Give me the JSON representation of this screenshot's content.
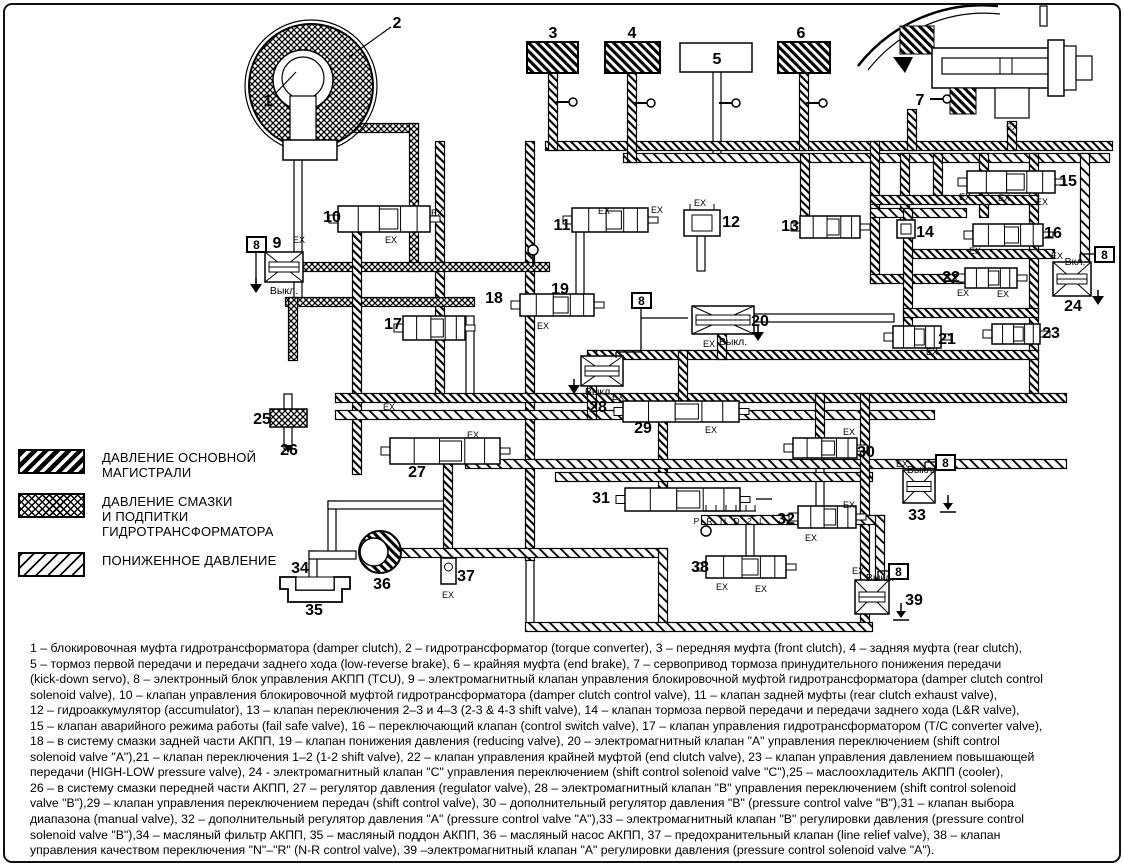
{
  "legend": {
    "items": [
      {
        "id": "main",
        "label": "ДАВЛЕНИЕ ОСНОВНОЙ\nМАГИСТРАЛИ"
      },
      {
        "id": "lube",
        "label": "ДАВЛЕНИЕ СМАЗКИ\nИ ПОДПИТКИ\nГИДРОТРАНСФОРМАТОРА"
      },
      {
        "id": "low",
        "label": "ПОНИЖЕННОЕ ДАВЛЕНИЕ"
      }
    ]
  },
  "diagram": {
    "callouts": [
      {
        "t": "1",
        "x": 268,
        "y": 101
      },
      {
        "t": "2",
        "x": 397,
        "y": 23
      },
      {
        "t": "3",
        "x": 553,
        "y": 33
      },
      {
        "t": "4",
        "x": 632,
        "y": 33
      },
      {
        "t": "5",
        "x": 717,
        "y": 59
      },
      {
        "t": "6",
        "x": 801,
        "y": 33
      },
      {
        "t": "7",
        "x": 920,
        "y": 100
      },
      {
        "t": "9",
        "x": 277,
        "y": 243
      },
      {
        "t": "10",
        "x": 332,
        "y": 217
      },
      {
        "t": "11",
        "x": 562,
        "y": 225
      },
      {
        "t": "12",
        "x": 731,
        "y": 222
      },
      {
        "t": "13",
        "x": 790,
        "y": 226
      },
      {
        "t": "14",
        "x": 925,
        "y": 232
      },
      {
        "t": "15",
        "x": 1068,
        "y": 181
      },
      {
        "t": "16",
        "x": 1053,
        "y": 233
      },
      {
        "t": "17",
        "x": 393,
        "y": 324
      },
      {
        "t": "18",
        "x": 494,
        "y": 298
      },
      {
        "t": "19",
        "x": 560,
        "y": 289
      },
      {
        "t": "20",
        "x": 760,
        "y": 321
      },
      {
        "t": "21",
        "x": 947,
        "y": 339
      },
      {
        "t": "22",
        "x": 951,
        "y": 277
      },
      {
        "t": "23",
        "x": 1051,
        "y": 333
      },
      {
        "t": "24",
        "x": 1073,
        "y": 306
      },
      {
        "t": "25",
        "x": 262,
        "y": 419
      },
      {
        "t": "26",
        "x": 289,
        "y": 450
      },
      {
        "t": "27",
        "x": 417,
        "y": 472
      },
      {
        "t": "28",
        "x": 598,
        "y": 407
      },
      {
        "t": "29",
        "x": 643,
        "y": 428
      },
      {
        "t": "30",
        "x": 866,
        "y": 452
      },
      {
        "t": "31",
        "x": 601,
        "y": 498
      },
      {
        "t": "32",
        "x": 786,
        "y": 519
      },
      {
        "t": "33",
        "x": 917,
        "y": 515
      },
      {
        "t": "34",
        "x": 300,
        "y": 568
      },
      {
        "t": "35",
        "x": 314,
        "y": 610
      },
      {
        "t": "36",
        "x": 382,
        "y": 584
      },
      {
        "t": "37",
        "x": 466,
        "y": 576
      },
      {
        "t": "38",
        "x": 700,
        "y": 567
      },
      {
        "t": "39",
        "x": 914,
        "y": 600
      }
    ],
    "tcu_boxes": [
      {
        "t": "8",
        "x": 247,
        "y": 237
      },
      {
        "t": "8",
        "x": 632,
        "y": 293
      },
      {
        "t": "8",
        "x": 1095,
        "y": 247
      },
      {
        "t": "8",
        "x": 936,
        "y": 455
      },
      {
        "t": "8",
        "x": 889,
        "y": 564
      }
    ],
    "ex_labels": [
      {
        "t": "EX",
        "x": 299,
        "y": 240
      },
      {
        "t": "EX",
        "x": 391,
        "y": 240
      },
      {
        "t": "EX",
        "x": 437,
        "y": 213
      },
      {
        "t": "EX",
        "x": 604,
        "y": 211
      },
      {
        "t": "EX",
        "x": 657,
        "y": 210
      },
      {
        "t": "EX",
        "x": 700,
        "y": 203
      },
      {
        "t": "EX",
        "x": 965,
        "y": 197
      },
      {
        "t": "EX",
        "x": 1004,
        "y": 198
      },
      {
        "t": "EX",
        "x": 1042,
        "y": 202
      },
      {
        "t": "EX",
        "x": 975,
        "y": 251
      },
      {
        "t": "EX",
        "x": 543,
        "y": 326
      },
      {
        "t": "EX",
        "x": 932,
        "y": 352
      },
      {
        "t": "EX",
        "x": 963,
        "y": 293
      },
      {
        "t": "EX",
        "x": 1003,
        "y": 294
      },
      {
        "t": "EX",
        "x": 1057,
        "y": 256
      },
      {
        "t": "EX",
        "x": 389,
        "y": 407
      },
      {
        "t": "EX",
        "x": 473,
        "y": 435
      },
      {
        "t": "EX",
        "x": 618,
        "y": 397
      },
      {
        "t": "EX",
        "x": 711,
        "y": 430
      },
      {
        "t": "EX",
        "x": 849,
        "y": 432
      },
      {
        "t": "EX",
        "x": 849,
        "y": 505
      },
      {
        "t": "EX",
        "x": 811,
        "y": 538
      },
      {
        "t": "EX",
        "x": 902,
        "y": 464
      },
      {
        "t": "EX",
        "x": 448,
        "y": 595
      },
      {
        "t": "EX",
        "x": 722,
        "y": 587
      },
      {
        "t": "EX",
        "x": 761,
        "y": 589
      },
      {
        "t": "EX",
        "x": 858,
        "y": 571
      },
      {
        "t": "EX",
        "x": 1012,
        "y": 127
      },
      {
        "t": "EX",
        "x": 709,
        "y": 344
      }
    ],
    "state_labels": [
      {
        "t": "Выкл.",
        "x": 284,
        "y": 290
      },
      {
        "t": "Выкл.",
        "x": 733,
        "y": 341
      },
      {
        "t": "Выкл.",
        "x": 599,
        "y": 391
      },
      {
        "t": "Выкл.",
        "x": 921,
        "y": 469
      },
      {
        "t": "Выкл.",
        "x": 880,
        "y": 577
      },
      {
        "t": "Вкл.",
        "x": 1075,
        "y": 261
      }
    ],
    "range_indicator": "P R N D 2 L"
  },
  "caption": {
    "lines": [
      "1 – блокировочная муфта гидротрансформатора (damper clutch), 2 – гидротрансформатор (torque converter), 3 – передняя муфта (front clutch), 4 – задняя муфта (rear clutch),",
      "5 – тормоз первой передачи и передачи заднего хода (low-reverse brake), 6 – крайняя муфта (end brake), 7 – сервопривод тормоза принудительного понижения передачи",
      "(kick-down servo), 8 – электронный блок управления АКПП (TCU), 9 – электромагнитный клапан управления блокировочной муфтой гидротрансформатора (damper clutch control",
      "solenoid valve), 10 – клапан управления блокировочной муфтой гидротрансформатора (damper clutch control valve), 11 – клапан задней муфты (rear clutch exhaust valve),",
      "12 – гидроаккумулятор (accumulator), 13 – клапан переключения 2–3 и 4–3 (2-3 & 4-3 shift valve), 14 – клапан тормоза первой передачи и передачи заднего хода (L&R valve),",
      "15 – клапан аварийного режима работы (fail safe valve), 16 – переключающий клапан (control switch valve), 17 – клапан управления гидротрансформатором (T/C converter valve),",
      "18 – в систему смазки задней части АКПП, 19 – клапан понижения давления (reducing valve), 20 – электромагнитный клапан \"А\" управления переключением (shift control",
      "solenoid valve \"A\"),21 – клапан переключения 1–2 (1-2 shift valve), 22 – клапан управления крайней муфтой (end clutch valve), 23 – клапан управления давлением повышающей",
      "передачи (HIGH-LOW pressure valve), 24 - электромагнитный клапан \"С\" управления переключением (shift control solenoid valve \"С\"),25 – маслоохладитель АКПП (cooler),",
      "26 – в систему смазки передней части АКПП, 27 – регулятор давления (regulator valve), 28 – электромагнитный клапан \"В\" управления переключением (shift control solenoid",
      "valve \"В\"),29 – клапан управления переключением передач (shift control valve), 30 – дополнительный регулятор давления \"В\" (pressure control valve \"В\"),31 – клапан выбора",
      "диапазона (manual valve), 32 – дополнительный регулятор давления \"А\" (pressure control valve \"А\"),33 – электромагнитный клапан \"В\" регулировки давления (pressure control",
      "solenoid valve \"В\"),34 – масляный фильтр АКПП, 35 – масляный поддон АКПП, 36 – масляный насос АКПП, 37 – предохранительный клапан (line relief valve), 38 – клапан",
      "управления качеством переключения \"N\"–\"R\" (N-R control valve), 39 –электромагнитный клапан \"А\" регулировки давления (pressure control solenoid valve \"А\")."
    ]
  }
}
